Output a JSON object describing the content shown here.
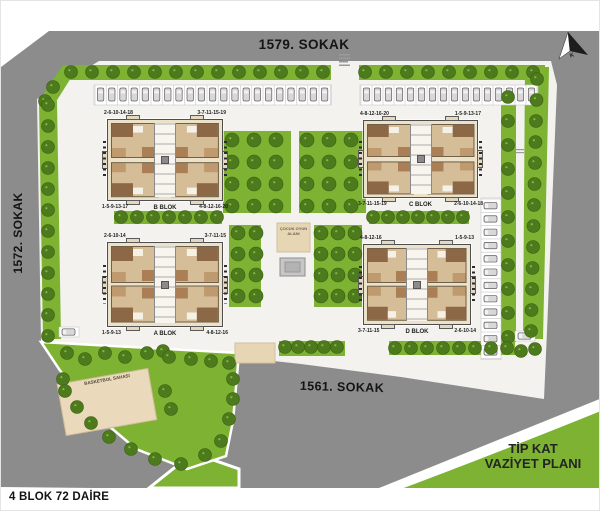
{
  "streets": {
    "top": "1579. SOKAK",
    "left": "1572. SOKAK",
    "bottom": "1561. SOKAK"
  },
  "title_block": {
    "line1": "TİP KAT",
    "line2": "VAZİYET PLANI"
  },
  "footer": {
    "text": "4 BLOK 72 DAİRE"
  },
  "north": {
    "label": "K"
  },
  "amenities": {
    "playground": "ÇOCUK OYUN ALANI",
    "basketball": "BASKETBOL SAHASI"
  },
  "blocks": [
    {
      "name": "A BLOK",
      "corner_tl": "2-6-10-14",
      "corner_tr": "3-7-11-15",
      "corner_bl": "1-5-9-13",
      "corner_br": "4-8-12-16"
    },
    {
      "name": "B BLOK",
      "corner_tl": "2-6-10-14-18",
      "corner_tr": "3-7-11-15-19",
      "corner_bl": "1-5-9-13-17",
      "corner_br": "4-8-12-16-20"
    },
    {
      "name": "C BLOK",
      "corner_tl": "4-8-12-16-20",
      "corner_tr": "1-5-9-13-17",
      "corner_bl": "3-7-11-15-19",
      "corner_br": "2-6-10-14-18"
    },
    {
      "name": "D BLOK",
      "corner_tl": "4-8-12-16",
      "corner_tr": "1-5-9-13",
      "corner_bl": "3-7-11-15",
      "corner_br": "2-6-10-14"
    }
  ],
  "colors": {
    "road": "#8c8c8c",
    "ground": "#f3f2ee",
    "green": "#7db233",
    "tree": "#4c7a1c",
    "tree_outline": "#3a5f11",
    "court": "#ead9ba",
    "sand": "#e7d6b3",
    "building_tan": "#ece1c9",
    "building_brown": "#8d6846",
    "car_gray": "#d8d8d8"
  }
}
